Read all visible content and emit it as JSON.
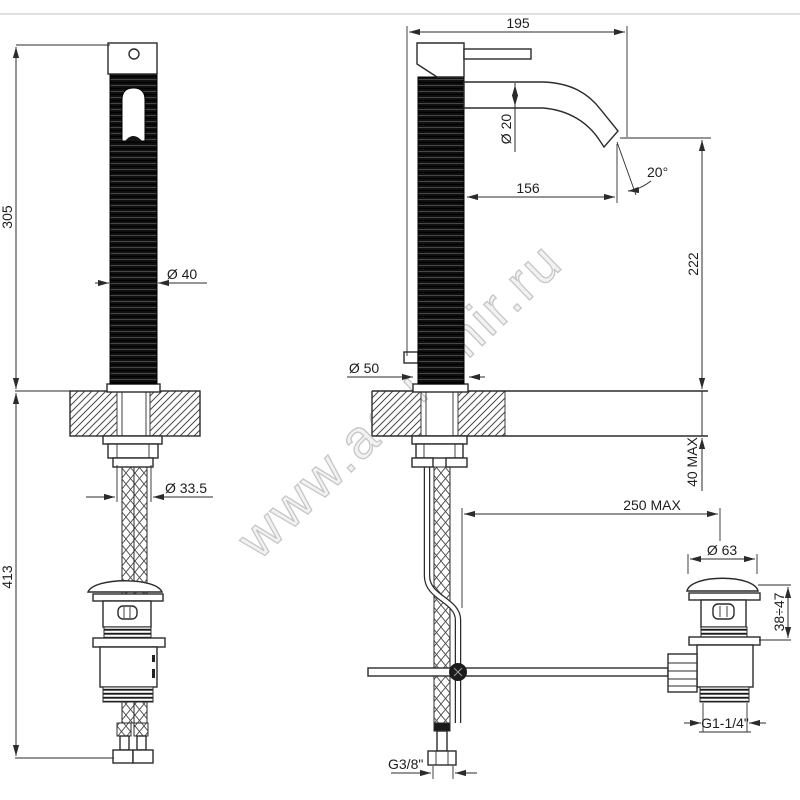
{
  "watermark": "www.aquamir.ru",
  "colors": {
    "line": "#2b2b2b",
    "page_rule": "#cccccc",
    "watermark_outline": "#c6c6c6",
    "body_fill": "#101010"
  },
  "labels": {
    "front_height_upper": "305",
    "front_height_lower": "413",
    "front_body_dia": "Ø 40",
    "front_hose_dia": "Ø 33.5",
    "side_depth": "195",
    "side_spout_dia": "Ø 20",
    "side_spout_reach": "156",
    "side_spout_angle": "20°",
    "side_spout_height": "222",
    "side_base_dia": "Ø 50",
    "side_deck_max": "40 MAX",
    "side_rod_reach": "250 MAX",
    "side_inlet_thread": "G3/8\"",
    "drain_cap_dia": "Ø 63",
    "drain_height_range": "38÷47",
    "drain_thread": "G1-1/4\""
  }
}
